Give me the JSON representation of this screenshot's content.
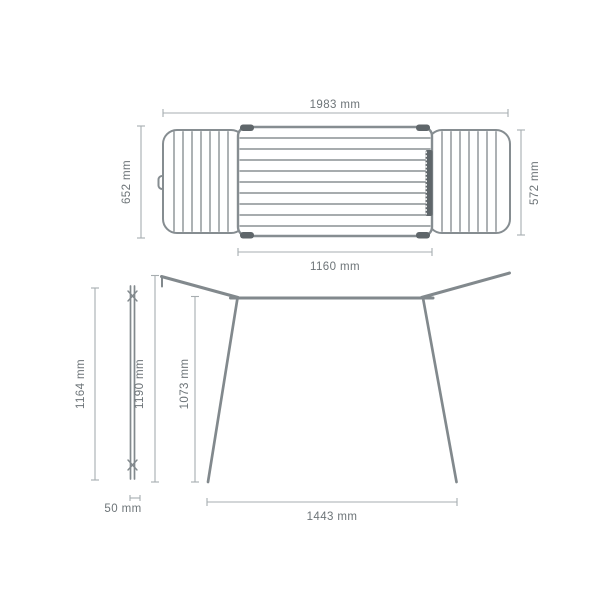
{
  "meta": {
    "title": "Clothes drying rack dimension diagram"
  },
  "colors": {
    "background": "#ffffff",
    "frame_gray": "#868d91",
    "dark_gray": "#5f666a",
    "dimension_line_gray": "#a7adb0",
    "label_gray": "#6d7478"
  },
  "views": {
    "top": {
      "overall_width": "1983 mm",
      "left_depth": "652 mm",
      "right_depth": "572 mm",
      "inner_width": "1160 mm"
    },
    "side_folded": {
      "folded_height": "1164 mm",
      "folded_depth": "50 mm"
    },
    "front": {
      "overall_height": "1190 mm",
      "rail_height": "1073 mm",
      "base_width": "1443 mm"
    }
  }
}
